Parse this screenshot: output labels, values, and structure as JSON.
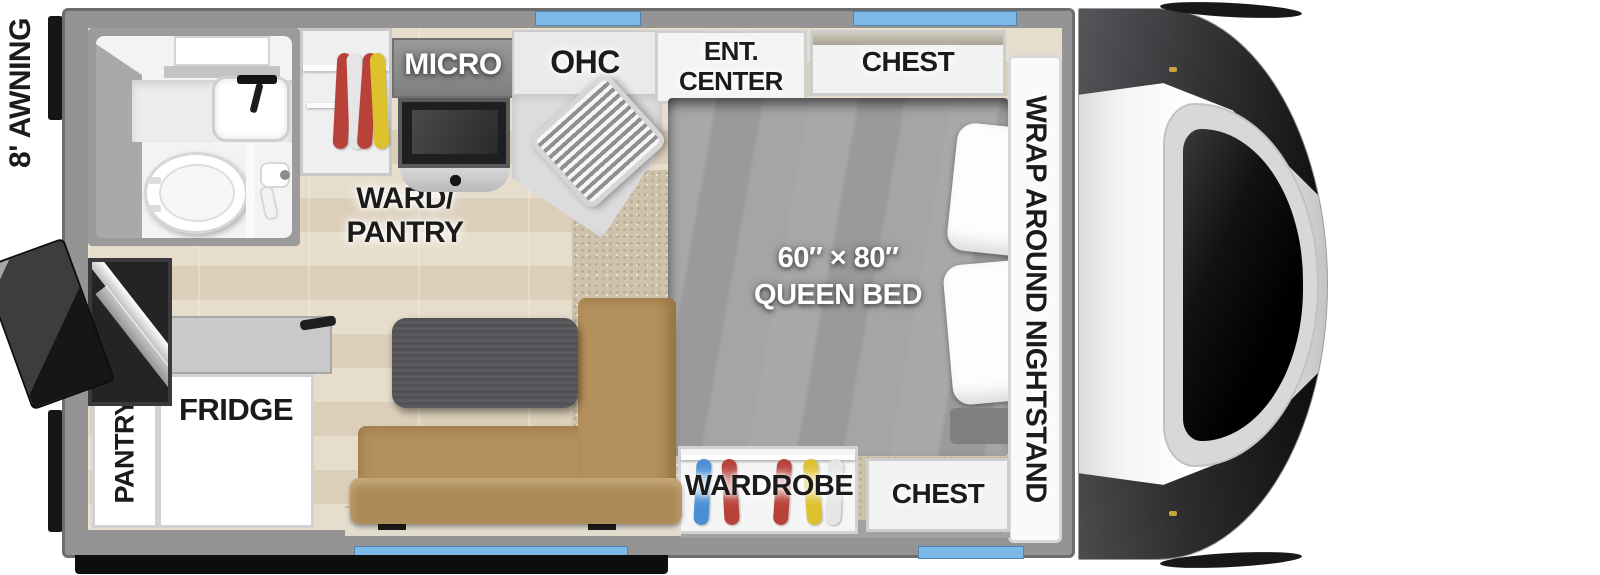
{
  "labels": {
    "awning": "8' AWNING",
    "micro": "MICRO",
    "ohc": "OHC",
    "ent_center_1": "ENT.",
    "ent_center_2": "CENTER",
    "chest_top": "CHEST",
    "ward_pantry_1": "WARD/",
    "ward_pantry_2": "PANTRY",
    "bed_size": "60″ × 80″",
    "bed_type": "QUEEN BED",
    "nightstand": "WRAP AROUND NIGHTSTAND",
    "wardrobe": "WARDROBE",
    "chest_bottom": "CHEST",
    "pantry": "PANTRY",
    "fridge": "FRIDGE"
  },
  "colors": {
    "window_blue": "#7cb9e9",
    "tv_accent_blue": "#2457b8",
    "sofa_tan": "#b3905c",
    "bed_gray": "#a2a2a2",
    "wall_gray": "#949494",
    "floor_wood": "#e0d4c2",
    "carpet_tan": "#cfc2ac",
    "cap_dark": "#2e2e30",
    "clothes_red": "#b8423a",
    "clothes_yellow": "#ddc22e",
    "clothes_blue": "#4a8fd4",
    "clothes_white": "#e6e6e6"
  }
}
